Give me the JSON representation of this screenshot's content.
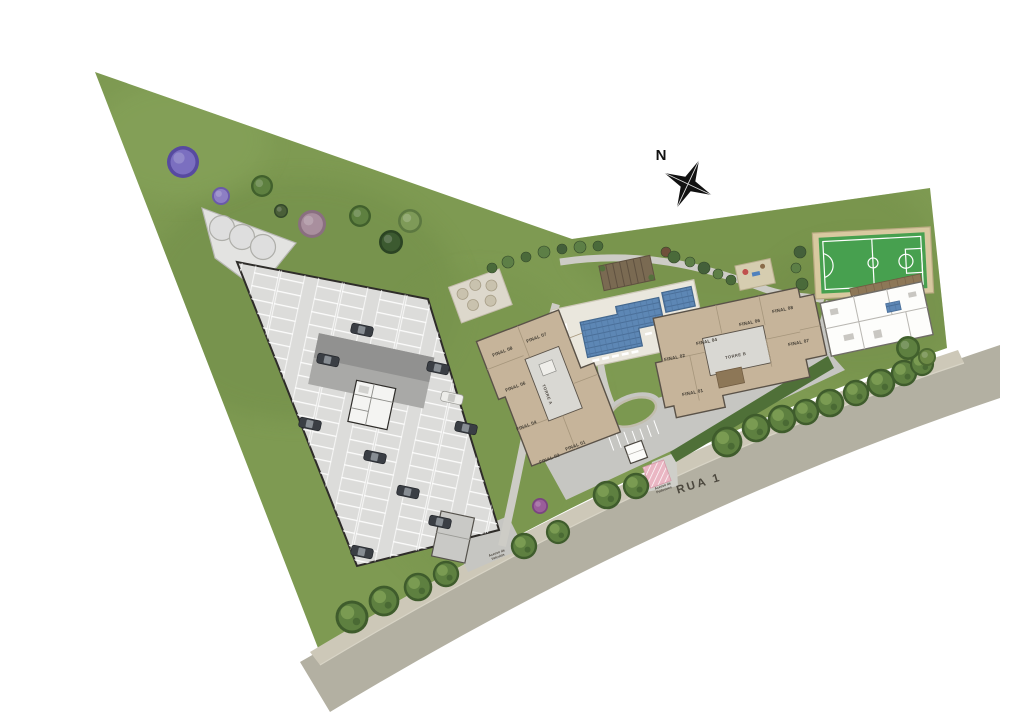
{
  "plan": {
    "north_label": "N",
    "street_label": "RUA 1",
    "towers": {
      "a": {
        "name": "TORRE A",
        "units": [
          "FINAL 08",
          "FINAL 07",
          "FINAL 06",
          "FINAL 04",
          "FINAL 02",
          "FINAL 01"
        ]
      },
      "b": {
        "name": "TORRE B",
        "units": [
          "FINAL 08",
          "FINAL 07",
          "FINAL 06",
          "FINAL 04",
          "FINAL 02",
          "FINAL 01"
        ]
      }
    },
    "access": {
      "pedestrian": {
        "line1": "Acesso de",
        "line2": "Pedestres"
      },
      "vehicle": {
        "line1": "Acesso de",
        "line2": "Veículos"
      }
    },
    "colors": {
      "grass": "#7e9a52",
      "road": "#b3b0a2",
      "sidewalk": "#cdc8b8",
      "drive": "#c6c6c2",
      "parking_deck": "#dcdcda",
      "tower": "#c6b49a",
      "core": "#d9d8d3",
      "pool": "#5d87b5",
      "court": "#47a04f",
      "court_border": "#d8c9a0",
      "hedge": "#4f7038",
      "pergola": "#7a6a52",
      "wood_deck": "#8d7757",
      "pedestrian_hatch": "#eab6c3"
    },
    "landscape": {
      "street_trees": [
        [
          352,
          617,
          1.5
        ],
        [
          384,
          601,
          1.4
        ],
        [
          418,
          587,
          1.3
        ],
        [
          446,
          574,
          1.2
        ],
        [
          524,
          546,
          1.2
        ],
        [
          558,
          532,
          1.1
        ],
        [
          607,
          495,
          1.3
        ],
        [
          636,
          486,
          1.2
        ],
        [
          727,
          442,
          1.4
        ],
        [
          756,
          428,
          1.3
        ],
        [
          782,
          419,
          1.3
        ],
        [
          806,
          412,
          1.2
        ],
        [
          830,
          403,
          1.3
        ],
        [
          856,
          393,
          1.2
        ],
        [
          881,
          383,
          1.3
        ],
        [
          904,
          373,
          1.2
        ],
        [
          922,
          364,
          1.1
        ]
      ],
      "ornamental_trees": [
        {
          "x": 183,
          "y": 162,
          "r": 16,
          "fill": "#7b6fc0",
          "edge": "#574aa0"
        },
        {
          "x": 221,
          "y": 196,
          "r": 9,
          "fill": "#8d7fc4",
          "edge": "#6a5aa8"
        },
        {
          "x": 262,
          "y": 186,
          "r": 11,
          "fill": "#5e8040",
          "edge": "#41602c"
        },
        {
          "x": 281,
          "y": 211,
          "r": 7,
          "fill": "#4a5f38",
          "edge": "#33482a"
        },
        {
          "x": 312,
          "y": 224,
          "r": 14,
          "fill": "#a98f9e",
          "edge": "#8a6f80"
        },
        {
          "x": 360,
          "y": 216,
          "r": 11,
          "fill": "#5e8040",
          "edge": "#41602c"
        },
        {
          "x": 410,
          "y": 221,
          "r": 12,
          "fill": "#7e9a58",
          "edge": "#5c7840"
        },
        {
          "x": 391,
          "y": 242,
          "r": 12,
          "fill": "#3c5a30",
          "edge": "#2b4423"
        },
        {
          "x": 540,
          "y": 506,
          "r": 8,
          "fill": "#9a5e9a",
          "edge": "#7a4480"
        },
        {
          "x": 908,
          "y": 348,
          "r": 12,
          "fill": "#5e8040",
          "edge": "#41602c"
        },
        {
          "x": 927,
          "y": 357,
          "r": 9,
          "fill": "#6d8a46",
          "edge": "#4d6a32"
        }
      ],
      "shrubs": [
        [
          492,
          268,
          5,
          "#4a6a3a"
        ],
        [
          508,
          262,
          6,
          "#5d7f46"
        ],
        [
          526,
          257,
          5,
          "#4a6a3a"
        ],
        [
          544,
          252,
          6,
          "#5d7f46"
        ],
        [
          562,
          249,
          5,
          "#44603a"
        ],
        [
          580,
          247,
          6,
          "#5d7f46"
        ],
        [
          598,
          246,
          5,
          "#4a6a3a"
        ],
        [
          666,
          252,
          5,
          "#6f4f3b"
        ],
        [
          674,
          257,
          6,
          "#4a6a3a"
        ],
        [
          690,
          262,
          5,
          "#5d7f46"
        ],
        [
          704,
          268,
          6,
          "#44603a"
        ],
        [
          718,
          274,
          5,
          "#5d7f46"
        ],
        [
          731,
          280,
          5,
          "#4a6a3a"
        ],
        [
          800,
          252,
          6,
          "#44603a"
        ],
        [
          796,
          268,
          5,
          "#5d7f46"
        ],
        [
          802,
          284,
          6,
          "#4a6a3a"
        ]
      ]
    },
    "parking": {
      "cars_dark": [
        [
          328,
          360
        ],
        [
          438,
          368
        ],
        [
          310,
          424
        ],
        [
          466,
          428
        ],
        [
          375,
          457
        ],
        [
          408,
          492
        ],
        [
          362,
          330
        ],
        [
          440,
          522
        ],
        [
          362,
          552
        ]
      ],
      "cars_light": [
        [
          452,
          398
        ]
      ]
    }
  }
}
